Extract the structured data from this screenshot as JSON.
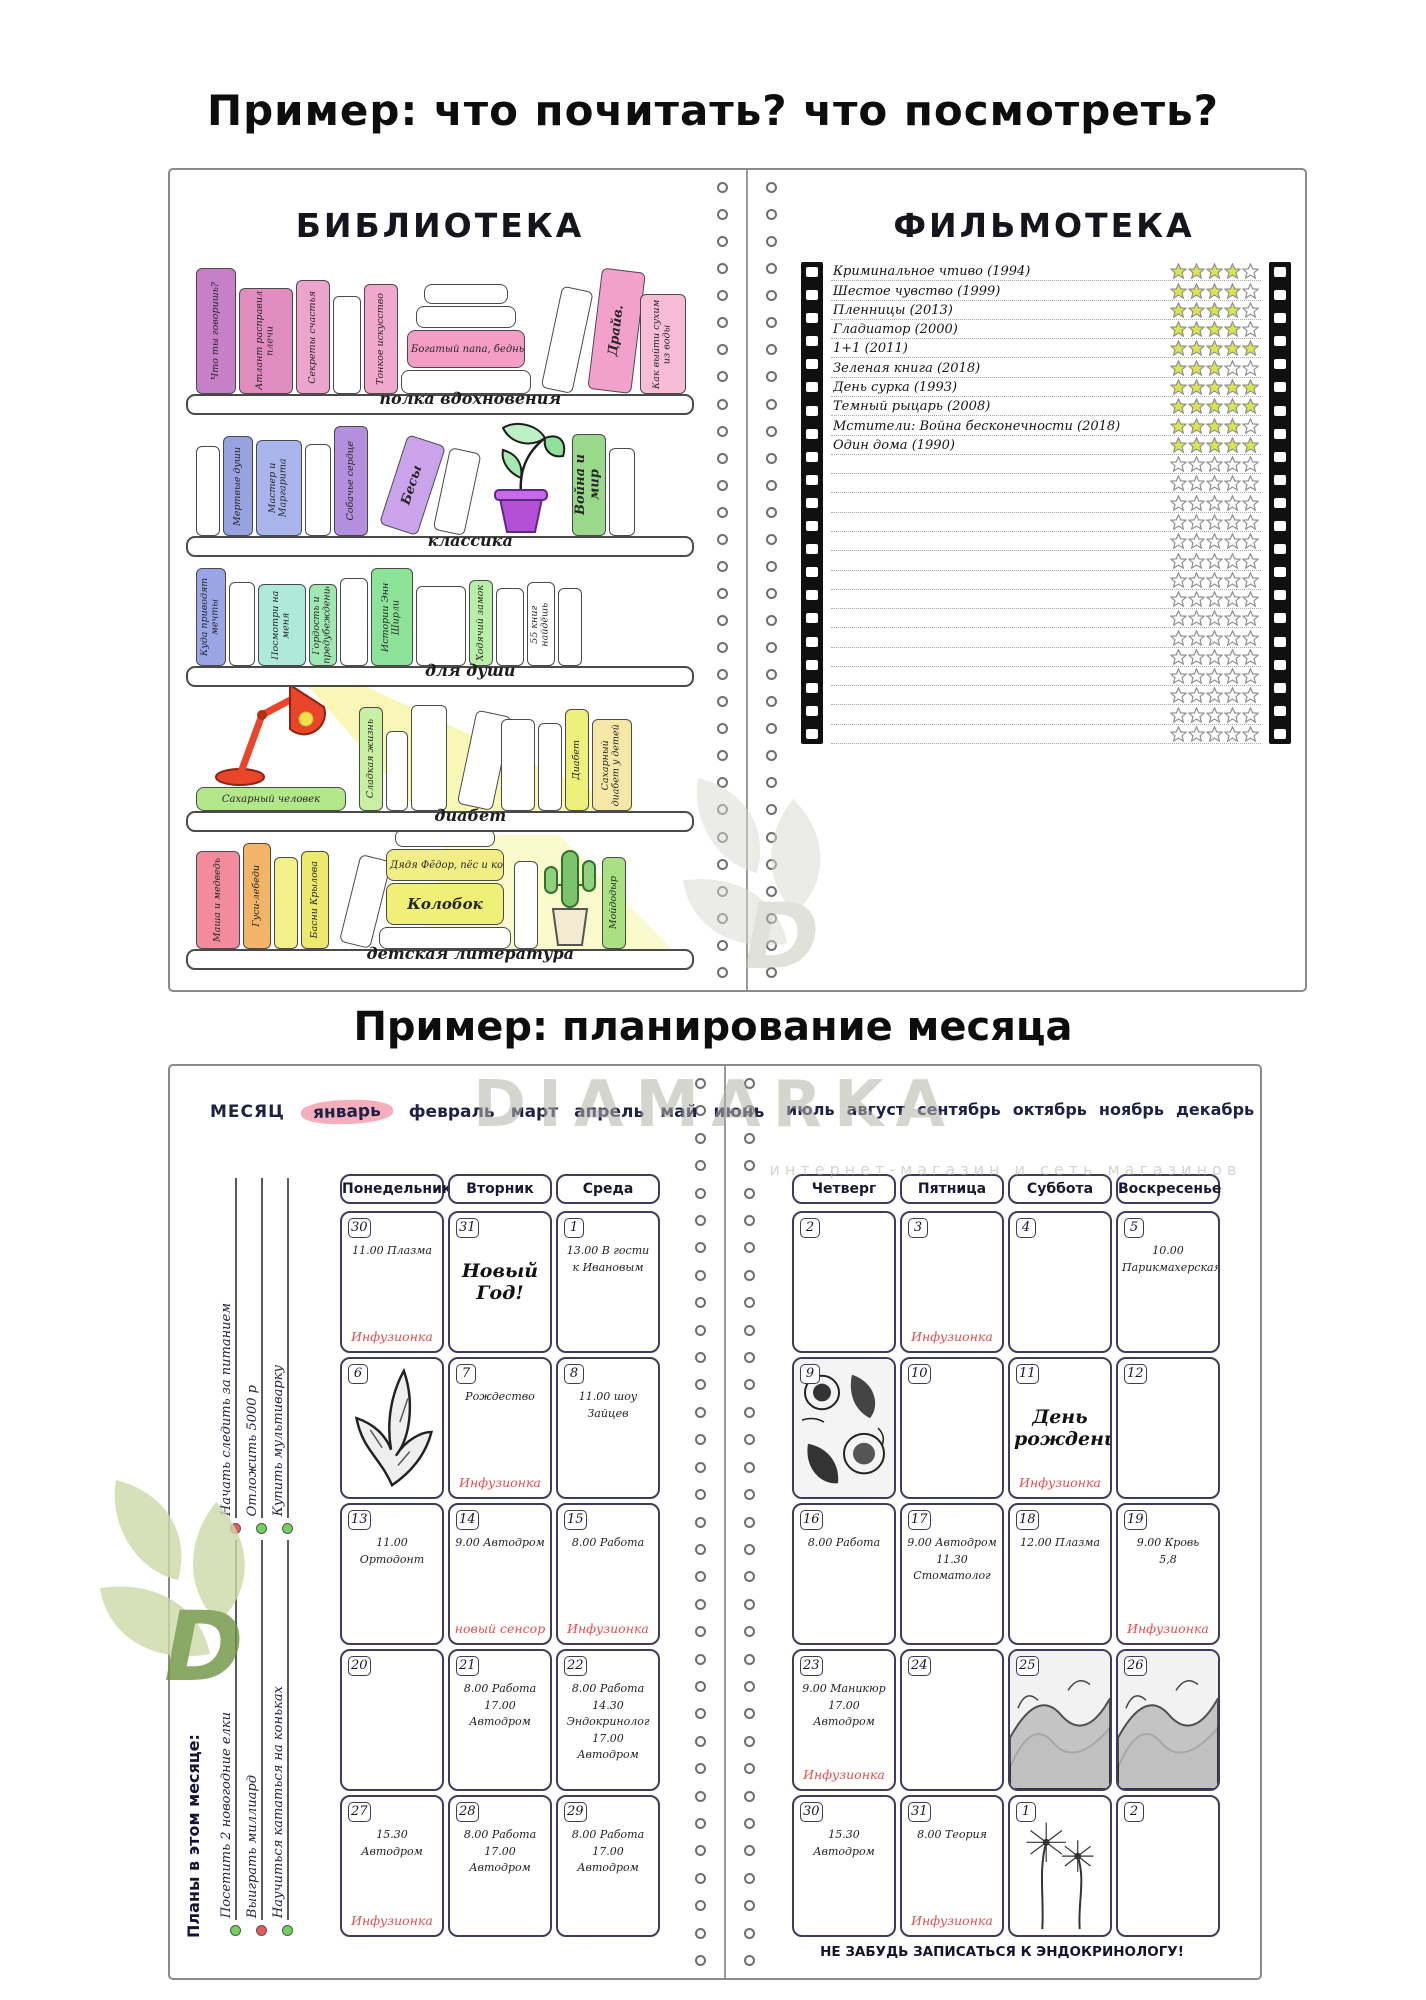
{
  "page": {
    "title_top": "Пример: что почитать? что посмотреть?",
    "title_bottom": "Пример: планирование месяца"
  },
  "watermark": {
    "brand": "DIAMARKA",
    "tagline": "интернет-магазин и сеть магазинов",
    "brand_color": "#b2b2a8",
    "leaf_color": "#ccdaa8",
    "leaf_letter_color": "#6f9440"
  },
  "library": {
    "title": "БИБЛИОТЕКА",
    "shelves": [
      {
        "label": "полка вдохновения",
        "books": [
          {
            "title": "Что ты говоришь?",
            "color": "#c77fc8",
            "w": 40,
            "h": 126
          },
          {
            "title": "Атлант расправил плечи",
            "color": "#e08cc0",
            "w": 54,
            "h": 106
          },
          {
            "title": "Секреты счастья",
            "color": "#eda4cc",
            "w": 34,
            "h": 114
          },
          {
            "title": "",
            "color": "#ffffff",
            "w": 28,
            "h": 98
          },
          {
            "title": "Тонкое искусство",
            "color": "#f0a8cc",
            "w": 34,
            "h": 110
          },
          {
            "kind": "stack",
            "books": [
              {
                "title": "",
                "color": "#ffffff",
                "w": 84,
                "h": 20
              },
              {
                "title": "",
                "color": "#ffffff",
                "w": 100,
                "h": 22
              },
              {
                "title": "Богатый папа, бедный папа",
                "color": "#f49ec6",
                "w": 118,
                "h": 38
              },
              {
                "title": "",
                "color": "#ffffff",
                "w": 130,
                "h": 24
              }
            ]
          },
          {
            "title": "",
            "color": "#ffffff",
            "w": 32,
            "h": 104,
            "tilt": 12
          },
          {
            "title": "Драйв.",
            "color": "#f2a2ca",
            "w": 44,
            "h": 122,
            "tilt": 7,
            "big": true
          },
          {
            "title": "Как выйти сухим из воды",
            "color": "#f6bcd8",
            "w": 46,
            "h": 100
          }
        ]
      },
      {
        "label": "классика",
        "books": [
          {
            "title": "",
            "color": "#ffffff",
            "w": 24,
            "h": 90
          },
          {
            "title": "Мертвые души",
            "color": "#97a2e0",
            "w": 30,
            "h": 100
          },
          {
            "title": "Мастер и Маргарита",
            "color": "#a9b3ec",
            "w": 46,
            "h": 96
          },
          {
            "title": "",
            "color": "#ffffff",
            "w": 26,
            "h": 92
          },
          {
            "title": "Собачье сердце",
            "color": "#b38fdd",
            "w": 34,
            "h": 110
          },
          {
            "title": "Бесы",
            "color": "#caa3ea",
            "w": 40,
            "h": 94,
            "tilt": 18,
            "big": true
          },
          {
            "title": "",
            "color": "#ffffff",
            "w": 32,
            "h": 84,
            "tilt": 12
          },
          {
            "kind": "plant"
          },
          {
            "title": "Война и мир",
            "color": "#9ad98c",
            "w": 34,
            "h": 102,
            "big": true
          },
          {
            "title": "",
            "color": "#ffffff",
            "w": 26,
            "h": 88
          }
        ]
      },
      {
        "label": "для души",
        "books": [
          {
            "title": "Куда приводят мечты",
            "color": "#98a6e6",
            "w": 30,
            "h": 98
          },
          {
            "title": "",
            "color": "#ffffff",
            "w": 26,
            "h": 84
          },
          {
            "title": "Посмотри на меня",
            "color": "#aee9d9",
            "w": 48,
            "h": 82
          },
          {
            "title": "Гордость и предубеждение",
            "color": "#9fe8b2",
            "w": 28,
            "h": 82
          },
          {
            "title": "",
            "color": "#ffffff",
            "w": 28,
            "h": 88
          },
          {
            "title": "Истории Энн Ширли",
            "color": "#8ce398",
            "w": 42,
            "h": 98
          },
          {
            "title": "",
            "color": "#ffffff",
            "w": 50,
            "h": 80
          },
          {
            "title": "Ходячий замок",
            "color": "#b9f0a9",
            "w": 24,
            "h": 86
          },
          {
            "title": "",
            "color": "#ffffff",
            "w": 28,
            "h": 78
          },
          {
            "title": "55 книг найдёшь",
            "color": "#ffffff",
            "w": 28,
            "h": 84
          },
          {
            "title": "",
            "color": "#ffffff",
            "w": 24,
            "h": 78
          }
        ]
      },
      {
        "label": "диабет",
        "books": [
          {
            "kind": "lamp",
            "book": {
              "title": "Сахарный человек",
              "color": "#b2e88a",
              "w": 150,
              "h": 24
            }
          },
          {
            "title": "Сладкая жизнь",
            "color": "#c9efa2",
            "w": 24,
            "h": 104
          },
          {
            "title": "",
            "color": "#ffffff",
            "w": 22,
            "h": 80
          },
          {
            "title": "",
            "color": "#ffffff",
            "w": 36,
            "h": 106
          },
          {
            "title": "",
            "color": "#ffffff",
            "w": 36,
            "h": 96,
            "tilt": 12
          },
          {
            "title": "",
            "color": "#ffffff",
            "w": 34,
            "h": 92
          },
          {
            "title": "",
            "color": "#ffffff",
            "w": 24,
            "h": 88
          },
          {
            "title": "Диабет",
            "color": "#eef07c",
            "w": 24,
            "h": 102
          },
          {
            "title": "Сахарный диабет у детей",
            "color": "#f6e9a8",
            "w": 40,
            "h": 92
          }
        ]
      },
      {
        "label": "детская литература",
        "books": [
          {
            "title": "Маша и медведь",
            "color": "#f28b9b",
            "w": 44,
            "h": 98
          },
          {
            "title": "Гуси-лебеди",
            "color": "#f2b468",
            "w": 28,
            "h": 106
          },
          {
            "title": "",
            "color": "#f4f08a",
            "w": 24,
            "h": 92
          },
          {
            "title": "Басни Крылова",
            "color": "#ece96e",
            "w": 28,
            "h": 98
          },
          {
            "title": "",
            "color": "#ffffff",
            "w": 32,
            "h": 90,
            "tilt": 14
          },
          {
            "kind": "stack",
            "books": [
              {
                "title": "",
                "color": "#ffffff",
                "w": 100,
                "h": 18
              },
              {
                "title": "Дядя Фёдор, пёс и кот",
                "color": "#f2ee86",
                "w": 118,
                "h": 32
              },
              {
                "title": "Колобок",
                "color": "#eef078",
                "w": 118,
                "h": 42,
                "big": true
              },
              {
                "title": "",
                "color": "#ffffff",
                "w": 132,
                "h": 22
              }
            ]
          },
          {
            "title": "",
            "color": "#ffffff",
            "w": 24,
            "h": 88
          },
          {
            "kind": "cactus"
          },
          {
            "title": "Мойдодыр",
            "color": "#a8e082",
            "w": 24,
            "h": 92
          }
        ]
      }
    ]
  },
  "filmoteka": {
    "title": "ФИЛЬМОТЕКА",
    "stars_max": 5,
    "star_filled_color": "#dbe64f",
    "star_outline_color": "#8f8f8f",
    "movies": [
      {
        "title": "Криминальное чтиво (1994)",
        "rating": 4
      },
      {
        "title": "Шестое чувство (1999)",
        "rating": 4
      },
      {
        "title": "Пленницы (2013)",
        "rating": 4
      },
      {
        "title": "Гладиатор (2000)",
        "rating": 4
      },
      {
        "title": "1+1 (2011)",
        "rating": 5
      },
      {
        "title": "Зеленая книга (2018)",
        "rating": 3
      },
      {
        "title": "День сурка (1993)",
        "rating": 5
      },
      {
        "title": "Темный рыцарь (2008)",
        "rating": 5
      },
      {
        "title": "Мстители: Война бесконечности (2018)",
        "rating": 4
      },
      {
        "title": "Один дома (1990)",
        "rating": 5
      }
    ],
    "empty_rows": 15
  },
  "planner": {
    "month_label": "МЕСЯЦ",
    "months_left": [
      "январь",
      "февраль",
      "март",
      "апрель",
      "май",
      "июнь"
    ],
    "highlight_index": 0,
    "highlight_color": "#f6aebd",
    "months_right": [
      "июль",
      "август",
      "сентябрь",
      "октябрь",
      "ноябрь",
      "декабрь"
    ],
    "accent_red": "#e04e4e",
    "sidebar": {
      "goals_top": [
        {
          "text": "Начать следить за питанием",
          "dot": "#e25c5c"
        },
        {
          "text": "Отложить 5000 р",
          "dot": "#6fd25a"
        },
        {
          "text": "Купить мультиварку",
          "dot": "#6fd25a"
        }
      ],
      "plans_header": "Планы в этом месяце:",
      "goals_bottom": [
        {
          "text": "Посетить 2 новогодние елки",
          "dot": "#6fd25a"
        },
        {
          "text": "Выиграть миллиард",
          "dot": "#e25c5c"
        },
        {
          "text": "Научиться кататься на коньках",
          "dot": "#6fd25a"
        }
      ]
    },
    "day_headers_left": [
      "Понедельник",
      "Вторник",
      "Среда"
    ],
    "day_headers_right": [
      "Четверг",
      "Пятница",
      "Суббота",
      "Воскресенье"
    ],
    "weeks": [
      {
        "left": [
          {
            "date": "30",
            "entries": [
              "11.00 Плазма"
            ],
            "red": "Инфузионка"
          },
          {
            "date": "31",
            "big": "Новый Год!"
          },
          {
            "date": "1",
            "entries": [
              "13.00 В гости к Ивановым"
            ]
          }
        ],
        "right": [
          {
            "date": "2"
          },
          {
            "date": "3",
            "red": "Инфузионка"
          },
          {
            "date": "4"
          },
          {
            "date": "5",
            "entries": [
              "10.00 Парикмахерская"
            ]
          }
        ]
      },
      {
        "left": [
          {
            "date": "6",
            "image": "lily"
          },
          {
            "date": "7",
            "entries": [
              "Рождество"
            ],
            "red": "Инфузионка"
          },
          {
            "date": "8",
            "entries": [
              "11.00 шоу Зайцев"
            ]
          }
        ],
        "right": [
          {
            "date": "9",
            "image": "paisley"
          },
          {
            "date": "10"
          },
          {
            "date": "11",
            "big": "День рождения!",
            "red": "Инфузионка"
          },
          {
            "date": "12"
          }
        ]
      },
      {
        "left": [
          {
            "date": "13",
            "entries": [
              "11.00 Ортодонт"
            ]
          },
          {
            "date": "14",
            "entries": [
              "9.00 Автодром"
            ],
            "red": "новый сенсор"
          },
          {
            "date": "15",
            "entries": [
              "8.00 Работа"
            ],
            "red": "Инфузионка"
          }
        ],
        "right": [
          {
            "date": "16",
            "entries": [
              "8.00 Работа"
            ]
          },
          {
            "date": "17",
            "entries": [
              "9.00 Автодром",
              "11.30 Стоматолог"
            ]
          },
          {
            "date": "18",
            "entries": [
              "12.00 Плазма"
            ]
          },
          {
            "date": "19",
            "entries": [
              "9.00 Кровь",
              "5,8"
            ],
            "red": "Инфузионка"
          }
        ]
      },
      {
        "left": [
          {
            "date": "20"
          },
          {
            "date": "21",
            "entries": [
              "8.00 Работа",
              "17.00 Автодром"
            ]
          },
          {
            "date": "22",
            "entries": [
              "8.00 Работа",
              "14.30 Эндокринолог",
              "17.00 Автодром"
            ]
          }
        ],
        "right": [
          {
            "date": "23",
            "entries": [
              "9.00 Маникюр",
              "17.00 Автодром"
            ],
            "red": "Инфузионка"
          },
          {
            "date": "24"
          },
          {
            "date": "25",
            "image": "mountains"
          },
          {
            "date": "26",
            "image": "mountains"
          }
        ]
      },
      {
        "left": [
          {
            "date": "27",
            "entries": [
              "15.30 Автодром"
            ],
            "red": "Инфузионка"
          },
          {
            "date": "28",
            "entries": [
              "8.00 Работа",
              "17.00 Автодром"
            ]
          },
          {
            "date": "29",
            "entries": [
              "8.00 Работа",
              "17.00 Автодром"
            ]
          }
        ],
        "right": [
          {
            "date": "30",
            "entries": [
              "15.30 Автодром"
            ]
          },
          {
            "date": "31",
            "entries": [
              "8.00 Теория"
            ],
            "red": "Инфузионка"
          },
          {
            "date": "1",
            "image": "dandelion"
          },
          {
            "date": "2"
          }
        ]
      }
    ],
    "footer_note": "НЕ ЗАБУДЬ ЗАПИСАТЬСЯ К ЭНДОКРИНОЛОГУ!"
  }
}
